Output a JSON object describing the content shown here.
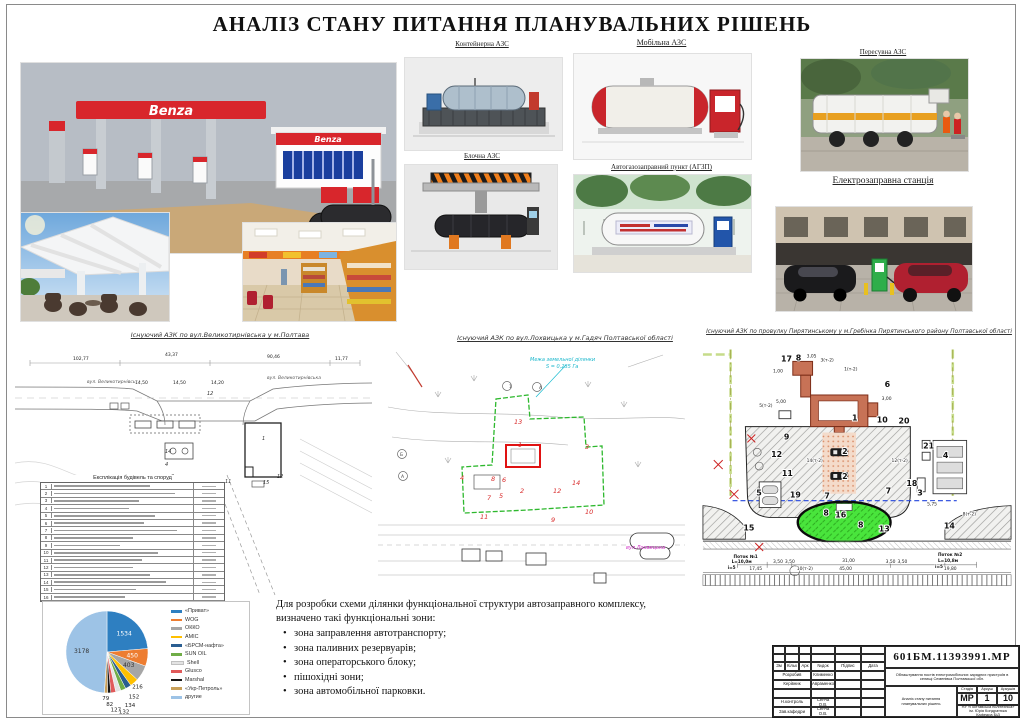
{
  "page": {
    "title": "АНАЛІЗ СТАНУ ПИТАННЯ ПЛАНУВАЛЬНИХ РІШЕНЬ"
  },
  "top": {
    "benza_sign": "Benza",
    "captions": {
      "container": "Контейнерна АЗС",
      "block": "Блочна АЗС",
      "mobile": "Мобільна АЗС",
      "agzp": "Автогазозаправний пункт (АГЗП)",
      "movable": "Пересувна АЗС",
      "electro": "Електрозаправна станція"
    }
  },
  "plans": {
    "left": {
      "caption": "Існуючий АЗК по вул.Великотирнівська у м.Полтава",
      "street1": "вул. Великотирнівська",
      "street2": "вул. Великотирнівська",
      "labels": [
        {
          "t": "102,77",
          "x": 58,
          "y": 17,
          "cls": "dim"
        },
        {
          "t": "43,37",
          "x": 150,
          "y": 13,
          "cls": "dim"
        },
        {
          "t": "90,46",
          "x": 252,
          "y": 15,
          "cls": "dim"
        },
        {
          "t": "11,77",
          "x": 320,
          "y": 17,
          "cls": "dim"
        },
        {
          "t": "14,50",
          "x": 120,
          "y": 41,
          "cls": "dim"
        },
        {
          "t": "14,50",
          "x": 158,
          "y": 41,
          "cls": "dim"
        },
        {
          "t": "14,20",
          "x": 196,
          "y": 41,
          "cls": "dim"
        },
        {
          "t": "12",
          "x": 192,
          "y": 52,
          "cls": "num2"
        },
        {
          "t": "1",
          "x": 247,
          "y": 97,
          "cls": "num2"
        },
        {
          "t": "14",
          "x": 150,
          "y": 110,
          "cls": "num2"
        },
        {
          "t": "4",
          "x": 150,
          "y": 123,
          "cls": "num2"
        },
        {
          "t": "3",
          "x": 156,
          "y": 135,
          "cls": "num2"
        },
        {
          "t": "10",
          "x": 170,
          "y": 150,
          "cls": "num2"
        },
        {
          "t": "11",
          "x": 210,
          "y": 140,
          "cls": "num2"
        },
        {
          "t": "12",
          "x": 262,
          "y": 135,
          "cls": "num2"
        },
        {
          "t": "15",
          "x": 248,
          "y": 141,
          "cls": "num2"
        }
      ],
      "table": {
        "title": "Експлікація будівель та споруд",
        "rows": [
          "1",
          "2",
          "3",
          "4",
          "5",
          "6",
          "7",
          "8",
          "9",
          "10",
          "11",
          "12",
          "13",
          "14",
          "15",
          "16"
        ]
      }
    },
    "middle": {
      "caption": "Існуючий АЗК по вул.Лохвицька у м.Гадяч Полтавської області",
      "note1": "Межа земельної ділянки",
      "note2": "S = 0,235 Га",
      "street": "вул.Лохвицька",
      "labels": [
        {
          "t": "13",
          "x": 136,
          "y": 77,
          "cls": "rnum"
        },
        {
          "t": "1",
          "x": 140,
          "y": 100,
          "cls": "rnum"
        },
        {
          "t": "3",
          "x": 207,
          "y": 102,
          "cls": "rnum"
        },
        {
          "t": "14",
          "x": 194,
          "y": 138,
          "cls": "rnum"
        },
        {
          "t": "12",
          "x": 175,
          "y": 146,
          "cls": "rnum"
        },
        {
          "t": "2",
          "x": 142,
          "y": 146,
          "cls": "rnum"
        },
        {
          "t": "6",
          "x": 124,
          "y": 135,
          "cls": "rnum"
        },
        {
          "t": "8",
          "x": 113,
          "y": 134,
          "cls": "rnum"
        },
        {
          "t": "4",
          "x": 82,
          "y": 133,
          "cls": "rnum"
        },
        {
          "t": "7",
          "x": 109,
          "y": 153,
          "cls": "rnum"
        },
        {
          "t": "5",
          "x": 121,
          "y": 151,
          "cls": "rnum"
        },
        {
          "t": "11",
          "x": 102,
          "y": 172,
          "cls": "rnum"
        },
        {
          "t": "9",
          "x": 173,
          "y": 175,
          "cls": "rnum"
        },
        {
          "t": "10",
          "x": 207,
          "y": 167,
          "cls": "rnum"
        },
        {
          "t": "1",
          "x": 131,
          "y": 41,
          "cls": "mark"
        },
        {
          "t": "А",
          "x": 161,
          "y": 42,
          "cls": "mark"
        },
        {
          "t": "Б",
          "x": 22,
          "y": 109,
          "cls": "mark"
        },
        {
          "t": "А",
          "x": 23,
          "y": 131,
          "cls": "mark"
        }
      ]
    },
    "right": {
      "caption": "Існуючий АЗК по провулку Пирятинському у м.Гребінка Пирятинського району  Полтавської області",
      "labels": [
        {
          "t": "17",
          "x": 84,
          "y": 16,
          "cls": "num"
        },
        {
          "t": "8",
          "x": 99,
          "y": 15,
          "cls": "num"
        },
        {
          "t": "6",
          "x": 189,
          "y": 42,
          "cls": "num"
        },
        {
          "t": "1",
          "x": 156,
          "y": 76,
          "cls": "num"
        },
        {
          "t": "10",
          "x": 181,
          "y": 78,
          "cls": "num"
        },
        {
          "t": "20",
          "x": 203,
          "y": 79,
          "cls": "num"
        },
        {
          "t": "9",
          "x": 87,
          "y": 95,
          "cls": "num"
        },
        {
          "t": "12",
          "x": 74,
          "y": 113,
          "cls": "num"
        },
        {
          "t": "11",
          "x": 85,
          "y": 132,
          "cls": "num"
        },
        {
          "t": "5",
          "x": 59,
          "y": 152,
          "cls": "num"
        },
        {
          "t": "19",
          "x": 93,
          "y": 154,
          "cls": "num"
        },
        {
          "t": "2",
          "x": 146,
          "y": 110,
          "cls": "num"
        },
        {
          "t": "2",
          "x": 146,
          "y": 135,
          "cls": "num"
        },
        {
          "t": "7",
          "x": 128,
          "y": 155,
          "cls": "num"
        },
        {
          "t": "7",
          "x": 190,
          "y": 150,
          "cls": "num"
        },
        {
          "t": "16",
          "x": 139,
          "y": 174,
          "cls": "num"
        },
        {
          "t": "8",
          "x": 127,
          "y": 172,
          "cls": "num"
        },
        {
          "t": "8",
          "x": 162,
          "y": 184,
          "cls": "num"
        },
        {
          "t": "13",
          "x": 183,
          "y": 188,
          "cls": "num"
        },
        {
          "t": "18",
          "x": 211,
          "y": 142,
          "cls": "num"
        },
        {
          "t": "3",
          "x": 222,
          "y": 152,
          "cls": "num"
        },
        {
          "t": "21",
          "x": 228,
          "y": 104,
          "cls": "num"
        },
        {
          "t": "4",
          "x": 248,
          "y": 114,
          "cls": "num"
        },
        {
          "t": "14",
          "x": 249,
          "y": 185,
          "cls": "num"
        },
        {
          "t": "15",
          "x": 46,
          "y": 187,
          "cls": "num"
        },
        {
          "t": "1,00",
          "x": 76,
          "y": 27,
          "cls": "dim"
        },
        {
          "t": "3,05",
          "x": 110,
          "y": 12,
          "cls": "dim"
        },
        {
          "t": "3(т-2)",
          "x": 124,
          "y": 16,
          "cls": "dim"
        },
        {
          "t": "1(т-2)",
          "x": 148,
          "y": 25,
          "cls": "dim"
        },
        {
          "t": "5(т-2)",
          "x": 62,
          "y": 62,
          "cls": "dim"
        },
        {
          "t": "5,00",
          "x": 79,
          "y": 58,
          "cls": "dim"
        },
        {
          "t": "3,00",
          "x": 186,
          "y": 55,
          "cls": "dim"
        },
        {
          "t": "14(т-2)",
          "x": 110,
          "y": 118,
          "cls": "dim"
        },
        {
          "t": "12(т-2)",
          "x": 196,
          "y": 118,
          "cls": "dim"
        },
        {
          "t": "5,75",
          "x": 232,
          "y": 162,
          "cls": "dim"
        },
        {
          "t": "8(т-2)",
          "x": 268,
          "y": 172,
          "cls": "dim"
        },
        {
          "t": "3,50",
          "x": 76,
          "y": 220,
          "cls": "dim"
        },
        {
          "t": "3,50",
          "x": 88,
          "y": 220,
          "cls": "dim"
        },
        {
          "t": "10(т-2)",
          "x": 100,
          "y": 227,
          "cls": "dim"
        },
        {
          "t": "31,00",
          "x": 146,
          "y": 219,
          "cls": "dim"
        },
        {
          "t": "45,00",
          "x": 143,
          "y": 227,
          "cls": "dim"
        },
        {
          "t": "3,50",
          "x": 190,
          "y": 220,
          "cls": "dim"
        },
        {
          "t": "3,50",
          "x": 202,
          "y": 220,
          "cls": "dim"
        },
        {
          "t": "17,45",
          "x": 52,
          "y": 227,
          "cls": "dim"
        },
        {
          "t": "19,80",
          "x": 249,
          "y": 227,
          "cls": "dim"
        },
        {
          "t": "Поток №1",
          "x": 36,
          "y": 215,
          "cls": "flow"
        },
        {
          "t": "L=10,0м",
          "x": 34,
          "y": 220,
          "cls": "flow"
        },
        {
          "t": "і=5",
          "x": 30,
          "y": 226,
          "cls": "flow"
        },
        {
          "t": "Поток №2",
          "x": 243,
          "y": 213,
          "cls": "flow"
        },
        {
          "t": "L=10,8м",
          "x": 243,
          "y": 219,
          "cls": "flow"
        },
        {
          "t": "і=5",
          "x": 240,
          "y": 225,
          "cls": "flow"
        }
      ]
    }
  },
  "chart_data": {
    "type": "pie",
    "title": "",
    "labels": [
      "«Приват»",
      "WOG",
      "ОККО",
      "АМІС",
      "«БРСМ-нафта»",
      "SUN OIL",
      "Shell",
      "Glusco",
      "Marshal",
      "«Укр-Петроль»",
      "другие"
    ],
    "values": [
      1534,
      450,
      403,
      216,
      152,
      134,
      132,
      127,
      82,
      79,
      3178
    ],
    "colors": [
      "#2e7fc1",
      "#ed7d31",
      "#a6a6a6",
      "#ffc000",
      "#2a5e91",
      "#70ad47",
      "#e3e3e3",
      "#e05a5a",
      "#171717",
      "#c8a05a",
      "#9dc3e6"
    ],
    "legend_position": "right"
  },
  "notes": {
    "line1": "Для розробки схеми ділянки функціональної структури автозаправного комплексу,",
    "line2": "визначено такі функціональні зони:",
    "bullets": [
      "зона заправлення автотранспорту;",
      "зона паливних резервуарів;",
      "зона операторського блоку;",
      "пішохідні зони;",
      "зона автомобільної парковки."
    ]
  },
  "stamp": {
    "doc_number": "601БМ.11393991.МР",
    "project": "Облаштування постів електромобільних зарядних пристроїв в селищі Семенівка Полтавської обл.",
    "sheet_title": "Аналіз стану питання планувальних рішень",
    "cols": [
      "Зм",
      "Кільк",
      "Арк",
      "№док",
      "Підпис",
      "Дата"
    ],
    "rows": [
      [
        "Розробив",
        "Клименко"
      ],
      [
        "Керівник",
        "Авраменко"
      ],
      [
        "Н.контроль",
        "Сенча О.В."
      ],
      [
        "Зав.кафедри",
        "Сенча О.В."
      ]
    ],
    "stage_label": "Стадія",
    "sheet_label": "Аркуш",
    "sheets_label": "Аркушів",
    "stage": "МР",
    "sheet": "1",
    "sheets": "10",
    "org1": "НУ «Полтавська політехніка»",
    "org2": "ім. Юрія Кондратюка",
    "org3": "Кафедра БіД"
  }
}
